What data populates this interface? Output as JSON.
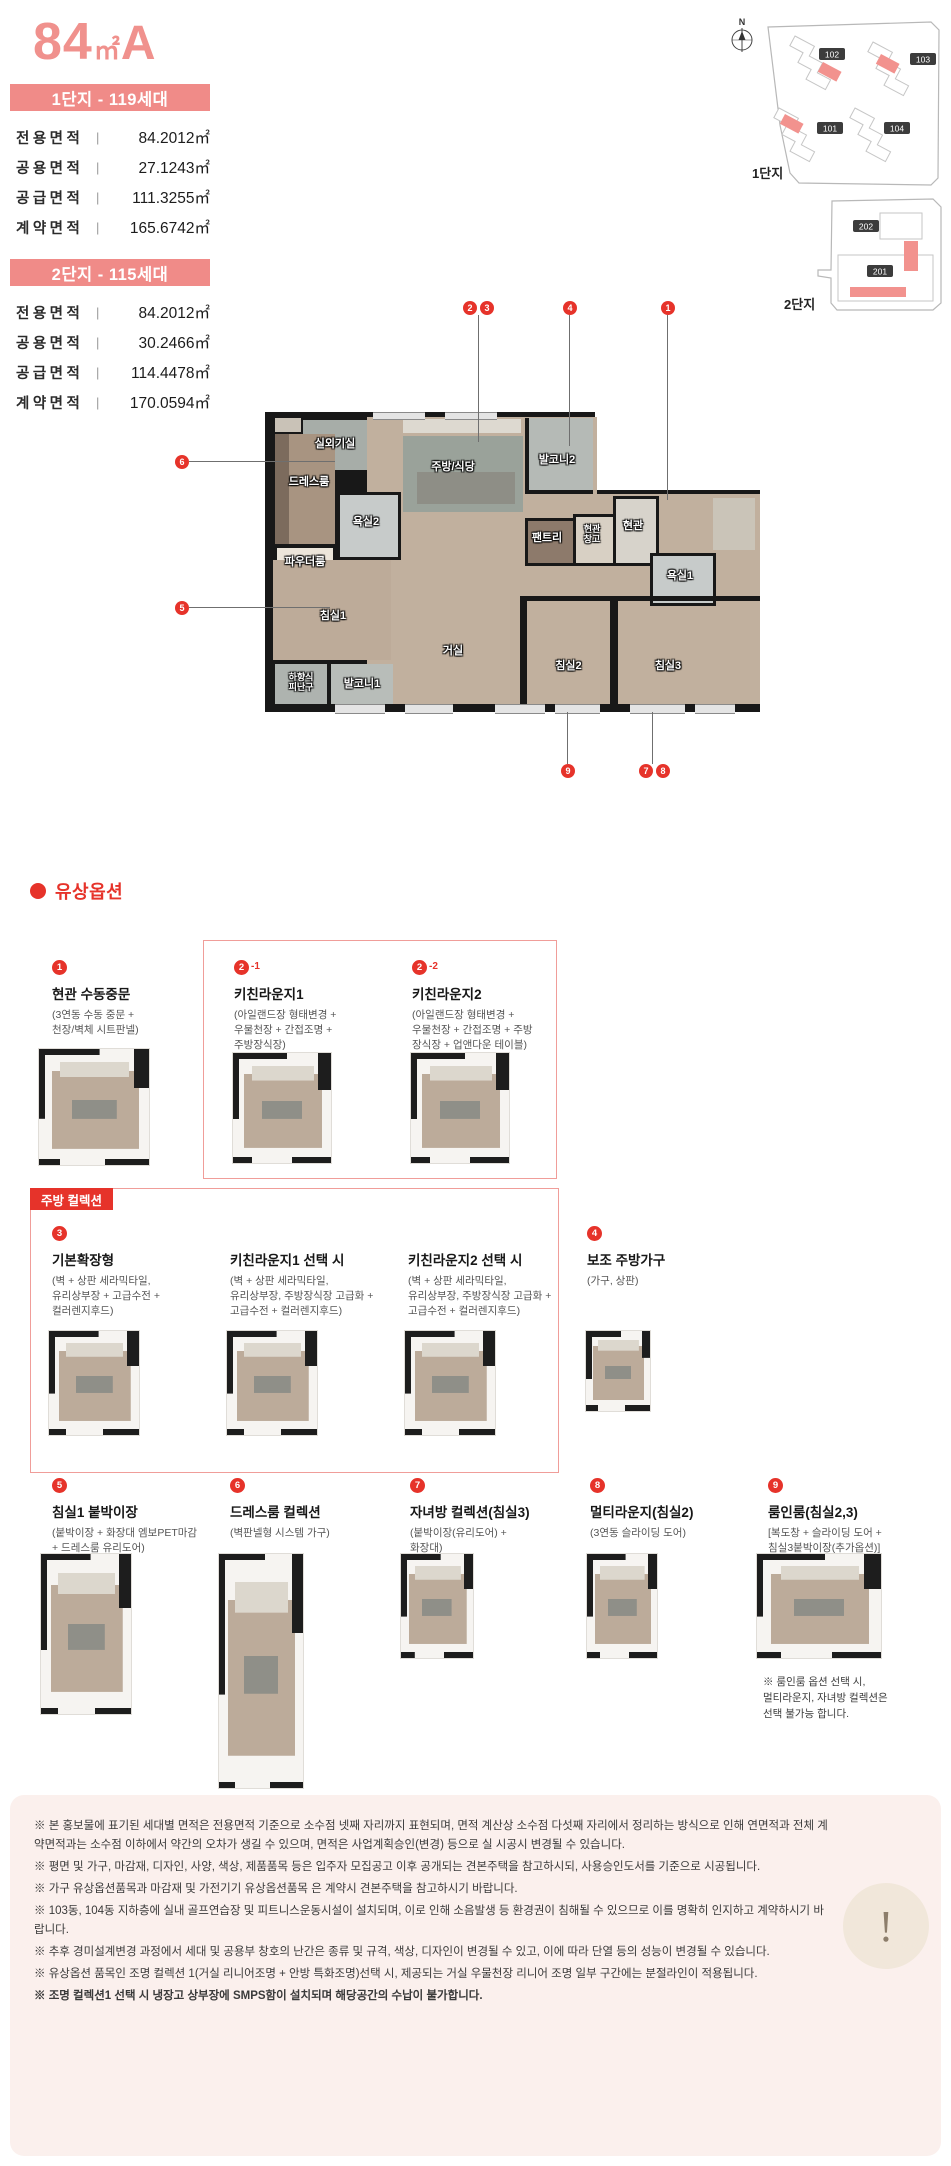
{
  "colors": {
    "salmon": "#f08b88",
    "red": "#e6332a",
    "disclaimer_bg": "#fbf0ed"
  },
  "header": {
    "size": "84",
    "unit": "㎡",
    "type": "A"
  },
  "divider": "|",
  "complex1": {
    "title": "1단지 - 119세대",
    "rows": [
      {
        "label": "전용면적",
        "value": "84.2012㎡"
      },
      {
        "label": "공용면적",
        "value": "27.1243㎡"
      },
      {
        "label": "공급면적",
        "value": "111.3255㎡"
      },
      {
        "label": "계약면적",
        "value": "165.6742㎡"
      }
    ]
  },
  "complex2": {
    "title": "2단지 - 115세대",
    "rows": [
      {
        "label": "전용면적",
        "value": "84.2012㎡"
      },
      {
        "label": "공용면적",
        "value": "30.2466㎡"
      },
      {
        "label": "공급면적",
        "value": "114.4478㎡"
      },
      {
        "label": "계약면적",
        "value": "170.0594㎡"
      }
    ]
  },
  "site1": {
    "label": "1단지",
    "compass": "N",
    "b101": "101",
    "b102": "102",
    "b103": "103",
    "b104": "104"
  },
  "site2": {
    "label": "2단지",
    "b201": "201",
    "b202": "202"
  },
  "plan": {
    "rooms": {
      "outdoor_unit": "실외기실",
      "dress": "드레스룸",
      "powder": "파우더룸",
      "bath2": "욕실2",
      "kitchen": "주방/식당",
      "balcony2": "발코니2",
      "pantry": "팬트리",
      "entry_storage": "현관\n창고",
      "entry": "현관",
      "bath1": "욕실1",
      "bed1": "침실1",
      "escape": "하향식\n피난구",
      "balcony1": "발코니1",
      "living": "거실",
      "bed2": "침실2",
      "bed3": "침실3"
    },
    "markers": {
      "entry": "1",
      "kitchen_a": "2",
      "kitchen_b": "3",
      "balcony2": "4",
      "bed1": "5",
      "dress": "6",
      "bed3_a": "7",
      "bed3_b": "8",
      "bed2": "9"
    }
  },
  "options": {
    "section_title": "유상옵션",
    "items": [
      {
        "num": "1",
        "suffix": "",
        "title": "현관 수동중문",
        "desc": "(3연동 수동 중문 +\n천장/벽체 시트판넬)"
      },
      {
        "num": "2",
        "suffix": "-1",
        "title": "키친라운지1",
        "desc": "(아일랜드장 형태변경 +\n우물천장 + 간접조명 +\n주방장식장)"
      },
      {
        "num": "2",
        "suffix": "-2",
        "title": "키친라운지2",
        "desc": "(아일랜드장 형태변경 +\n우물천장 + 간접조명 + 주방\n장식장 + 업앤다운 테이블)"
      }
    ],
    "kitchen": {
      "banner": "주방 컬렉션",
      "items": [
        {
          "num": "3",
          "title": "기본확장형",
          "desc": "(벽 + 상판 세라믹타일,\n유리상부장 + 고급수전 +\n컬러렌지후드)"
        },
        {
          "num": "",
          "title": "키친라운지1 선택 시",
          "desc": "(벽 + 상판 세라믹타일,\n유리상부장, 주방장식장 고급화 +\n고급수전 + 컬러렌지후드)"
        },
        {
          "num": "",
          "title": "키친라운지2 선택 시",
          "desc": "(벽 + 상판 세라믹타일,\n유리상부장, 주방장식장 고급화 +\n고급수전 + 컬러렌지후드)"
        },
        {
          "num": "4",
          "title": "보조 주방가구",
          "desc": "(가구, 상판)"
        }
      ]
    },
    "rooms": [
      {
        "num": "5",
        "title": "침실1 붙박이장",
        "desc": "(붙박이장 + 화장대 엠보PET마감\n+ 드레스룸 유리도어)"
      },
      {
        "num": "6",
        "title": "드레스룸 컬렉션",
        "desc": "(벽판넬형 시스템 가구)"
      },
      {
        "num": "7",
        "title": "자녀방 컬렉션(침실3)",
        "desc": "(붙박이장(유리도어) +\n화장대)"
      },
      {
        "num": "8",
        "title": "멀티라운지(침실2)",
        "desc": "(3연동 슬라이딩 도어)"
      },
      {
        "num": "9",
        "title": "룸인룸(침실2,3)",
        "desc": "[복도창 + 슬라이딩 도어 +\n침실3붙박이장(추가옵션)]"
      }
    ],
    "note": "※ 룸인룸 옵션 선택 시,\n멀티라운지, 자녀방 컬렉션은\n선택 불가능 합니다."
  },
  "disclaimer": {
    "mark": "!",
    "lines": [
      "※ 본 홍보물에 표기된 세대별 면적은 전용면적 기준으로 소수점 넷째 자리까지 표현되며, 면적 계산상 소수점 다섯째 자리에서 정리하는 방식으로 인해 연면적과 전체 계약면적과는 소수점 이하에서 약간의 오차가 생길 수 있으며, 면적은 사업계획승인(변경) 등으로 실 시공시 변경될 수 있습니다.",
      "※ 평면 및 가구, 마감재, 디자인, 사양, 색상, 제품품목 등은 입주자 모집공고 이후 공개되는 견본주택을 참고하시되, 사용승인도서를 기준으로 시공됩니다.",
      "※ 가구 유상옵션품목과 마감재 및 가전기기 유상옵션품목 은 계약시 견본주택을 참고하시기 바랍니다.",
      "※ 103동, 104동 지하층에 실내 골프연습장 및 피트니스운동시설이 설치되며, 이로 인해 소음발생 등 환경권이 침해될 수 있으므로 이를 명확히 인지하고 계약하시기 바랍니다.",
      "※ 추후 경미설계변경 과정에서 세대 및 공용부 창호의 난간은 종류 및 규격, 색상, 디자인이 변경될 수 있고, 이에 따라 단열 등의 성능이 변경될 수 있습니다.",
      "※ 유상옵션 품목인 조명 컬렉션 1(거실 리니어조명 + 안방 특화조명)선택 시, 제공되는 거실 우물천장 리니어 조명 일부 구간에는 분절라인이 적용됩니다.",
      "※ 조명 컬렉션1 선택 시 냉장고 상부장에 SMPS함이 설치되며 해당공간의 수납이 불가합니다."
    ]
  }
}
